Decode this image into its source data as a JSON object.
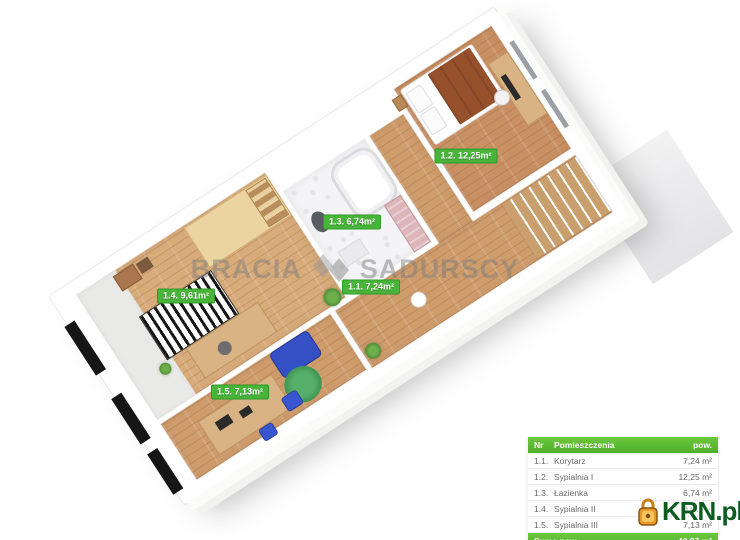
{
  "floorplan": {
    "watermark": {
      "left": "BRACIA",
      "right": "SADURSCY",
      "logo_icon": "house-emblem-icon"
    },
    "room_labels": [
      {
        "id": "1.1",
        "text": "1.1. 7,24m²"
      },
      {
        "id": "1.2",
        "text": "1.2. 12,25m²"
      },
      {
        "id": "1.3",
        "text": "1.3. 6,74m²"
      },
      {
        "id": "1.4",
        "text": "1.4. 9,61m²"
      },
      {
        "id": "1.5",
        "text": "1.5. 7,13m²"
      }
    ],
    "label_color": "#48b43a"
  },
  "legend_table": {
    "header": {
      "nr": "Nr",
      "name": "Pomieszczenia",
      "area": "pow."
    },
    "rows": [
      {
        "nr": "1.1.",
        "name": "Korytarz",
        "area": "7,24 m²"
      },
      {
        "nr": "1.2.",
        "name": "Sypialnia I",
        "area": "12,25 m²"
      },
      {
        "nr": "1.3.",
        "name": "Łazienka",
        "area": "6,74 m²"
      },
      {
        "nr": "1.4.",
        "name": "Sypialnia II",
        "area": "9,61 m²"
      },
      {
        "nr": "1.5.",
        "name": "Sypialnia III",
        "area": "7,13 m²"
      }
    ],
    "footer": {
      "label": "Suma pow.",
      "area": "42,97 m²"
    },
    "header_color": "#54b52e"
  },
  "brand": {
    "text": "KRN.pl",
    "text_color": "#0d5c1f",
    "icon": "padlock-icon",
    "icon_color": "#e89a28"
  }
}
